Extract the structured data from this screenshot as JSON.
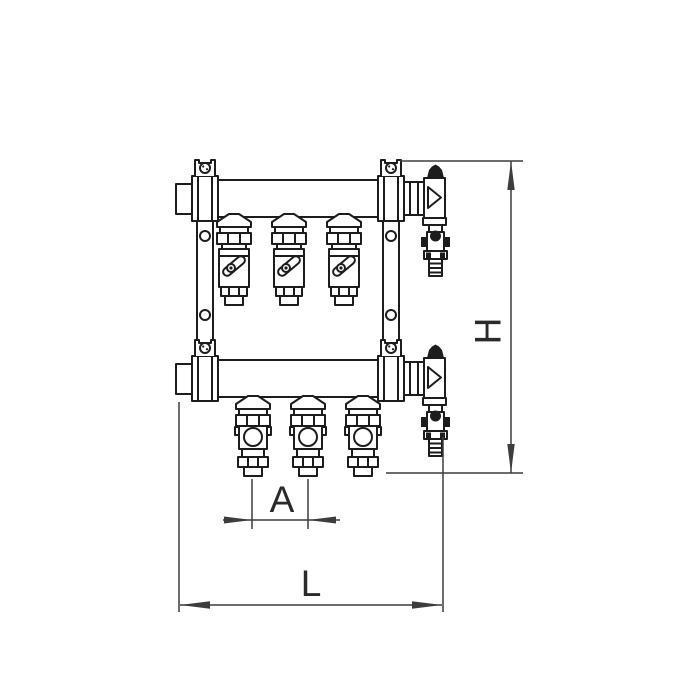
{
  "figure": {
    "labels": {
      "height": "H",
      "length": "L",
      "spacing": "A"
    }
  },
  "colors": {
    "line": "#1d1d1d",
    "dimension": "#3d3d3d",
    "background": "#ffffff"
  }
}
